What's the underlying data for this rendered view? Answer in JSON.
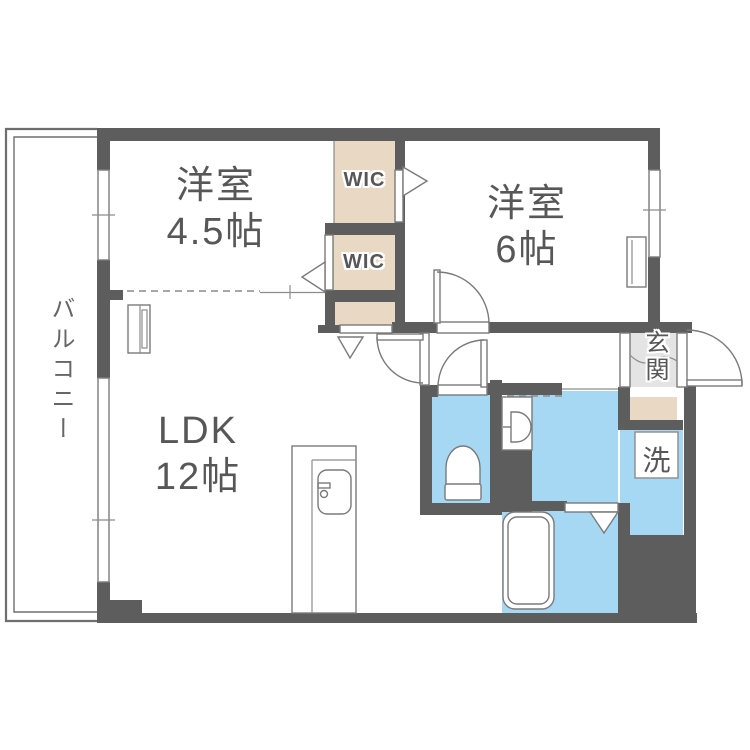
{
  "plan": {
    "rooms": {
      "western1": {
        "name": "洋室",
        "size": "4.5帖"
      },
      "western2": {
        "name": "洋室",
        "size": "6帖"
      },
      "ldk": {
        "name": "LDK",
        "size": "12帖"
      },
      "wic1": "WIC",
      "wic2": "WIC",
      "entrance": "玄関",
      "laundry": "洗",
      "balcony": "バルコニー"
    },
    "colors": {
      "wall": "#5d5d5d",
      "closet": "#e9d9c4",
      "wet": "#a6d8f3",
      "entrance_floor": "#e4e4e4",
      "line": "#7a7a7a",
      "label": "#575757"
    }
  }
}
